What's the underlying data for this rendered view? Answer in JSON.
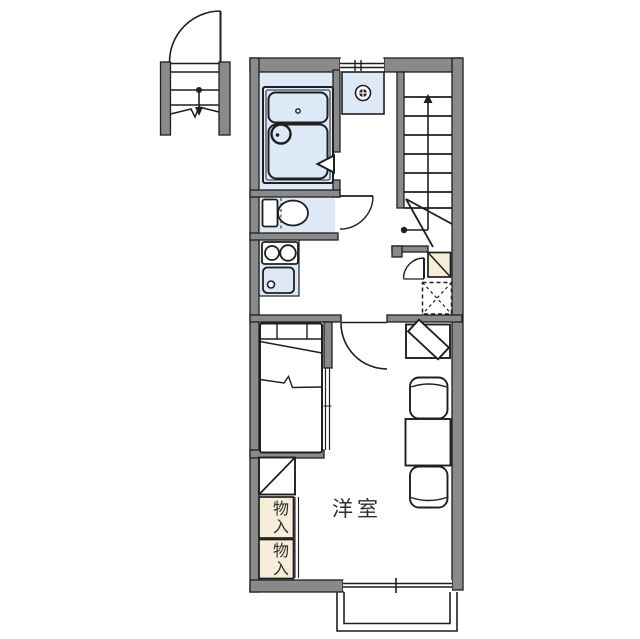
{
  "title": "apartment-floor-plan",
  "palette": {
    "wall_gray": "#8a8a8a",
    "line_black": "#1f1f1f",
    "water_blue": "#dde9f7",
    "storage_cream": "#f6eed8",
    "background": "#ffffff",
    "text": "#2e2e2e"
  },
  "labels": {
    "main_room": "洋室",
    "storage_upper": "物入",
    "storage_lower": "物入"
  },
  "features": [
    "ground-floor-entrance-door",
    "entrance-steps-with-break-line",
    "entrance-down-arrow",
    "staircase-with-winders",
    "staircase-up-arrow",
    "washing-machine-space",
    "unit-bath-bathtub",
    "round-washbasin",
    "bathroom-folding-door",
    "toilet",
    "toilet-swing-door",
    "two-burner-stove",
    "kitchen-sink",
    "unit-entry-swing-door",
    "shoe-cabinet",
    "refrigerator-space-dashed",
    "room-swing-door",
    "bed-with-headboard",
    "sliding-partition",
    "corner-shelf",
    "storage-closet-x2",
    "tv-on-angled-stand",
    "chair-x2",
    "dining-table",
    "top-window",
    "bottom-window",
    "balcony"
  ]
}
